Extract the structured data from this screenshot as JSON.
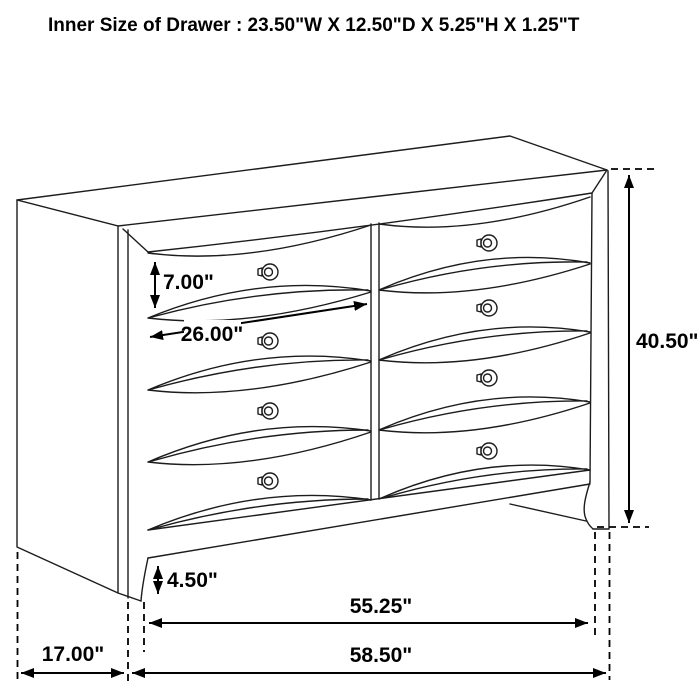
{
  "title": "Inner Size of Drawer : 23.50\"W X 12.50\"D X 5.25\"H X 1.25\"T",
  "dimension_labels": {
    "top_drawer_front_height": "7.00\"",
    "drawer_opening_width": "26.00\"",
    "overall_height": "40.50\"",
    "base_height": "4.50\"",
    "side_depth": "17.00\"",
    "front_body_width": "55.25\"",
    "overall_width": "58.50\""
  },
  "colors": {
    "line": "#000000",
    "background": "#ffffff"
  }
}
